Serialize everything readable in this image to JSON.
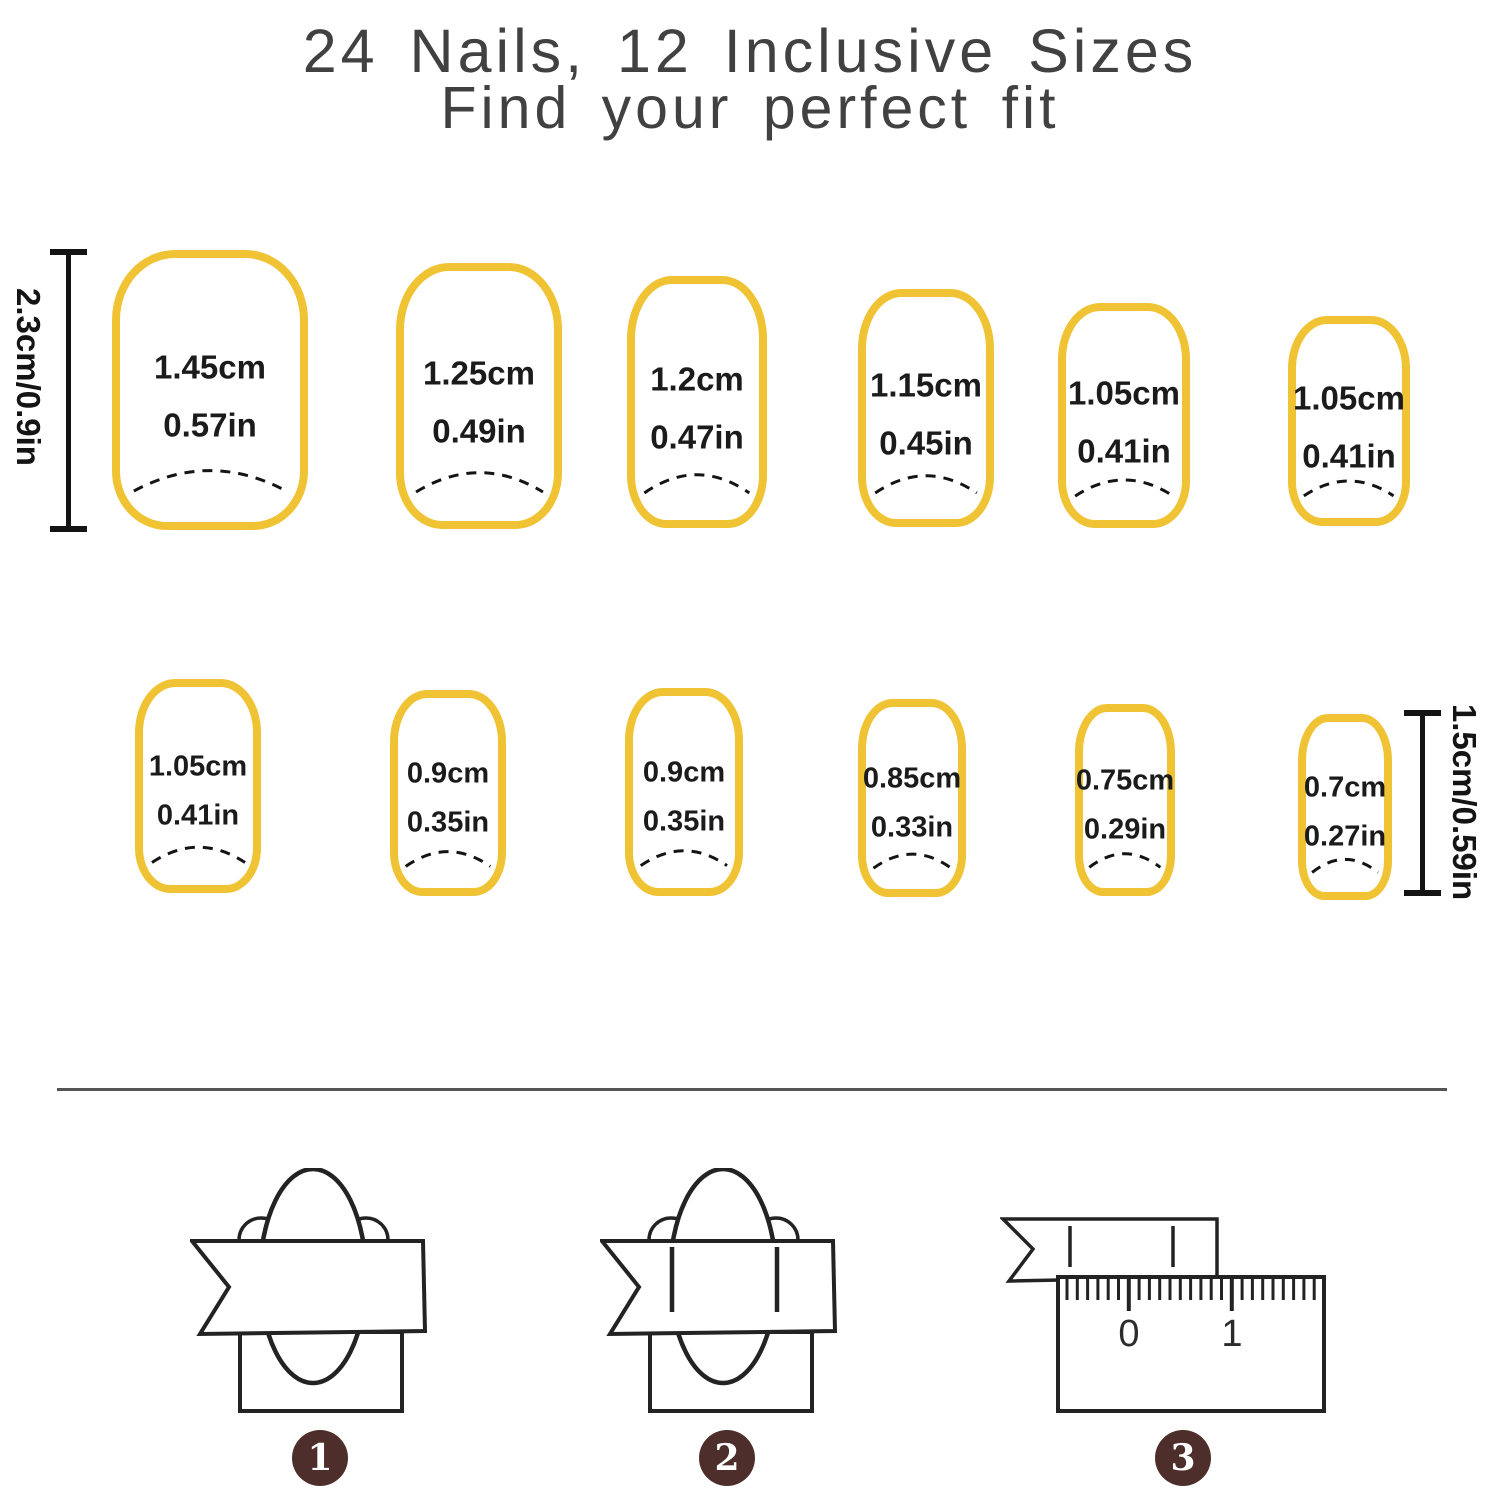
{
  "title": {
    "line1": "24 Nails, 12 Inclusive Sizes",
    "line2": "Find your perfect fit"
  },
  "measures": {
    "left": "2.3cm/0.9in",
    "right": "1.5cm/0.59in"
  },
  "nails": {
    "row1": [
      {
        "cm": "1.45cm",
        "inch": "0.57in"
      },
      {
        "cm": "1.25cm",
        "inch": "0.49in"
      },
      {
        "cm": "1.2cm",
        "inch": "0.47in"
      },
      {
        "cm": "1.15cm",
        "inch": "0.45in"
      },
      {
        "cm": "1.05cm",
        "inch": "0.41in"
      },
      {
        "cm": "1.05cm",
        "inch": "0.41in"
      }
    ],
    "row2": [
      {
        "cm": "1.05cm",
        "inch": "0.41in"
      },
      {
        "cm": "0.9cm",
        "inch": "0.35in"
      },
      {
        "cm": "0.9cm",
        "inch": "0.35in"
      },
      {
        "cm": "0.85cm",
        "inch": "0.33in"
      },
      {
        "cm": "0.75cm",
        "inch": "0.29in"
      },
      {
        "cm": "0.7cm",
        "inch": "0.27in"
      }
    ]
  },
  "diagram3": {
    "ruler_labels": [
      "0",
      "1"
    ]
  },
  "steps": [
    "1",
    "2",
    "3"
  ],
  "colors": {
    "nail_outline": "#F0C334",
    "diagram_line": "#232323",
    "text": "#1B1B1B",
    "step_circle": "#4D2E2B"
  }
}
